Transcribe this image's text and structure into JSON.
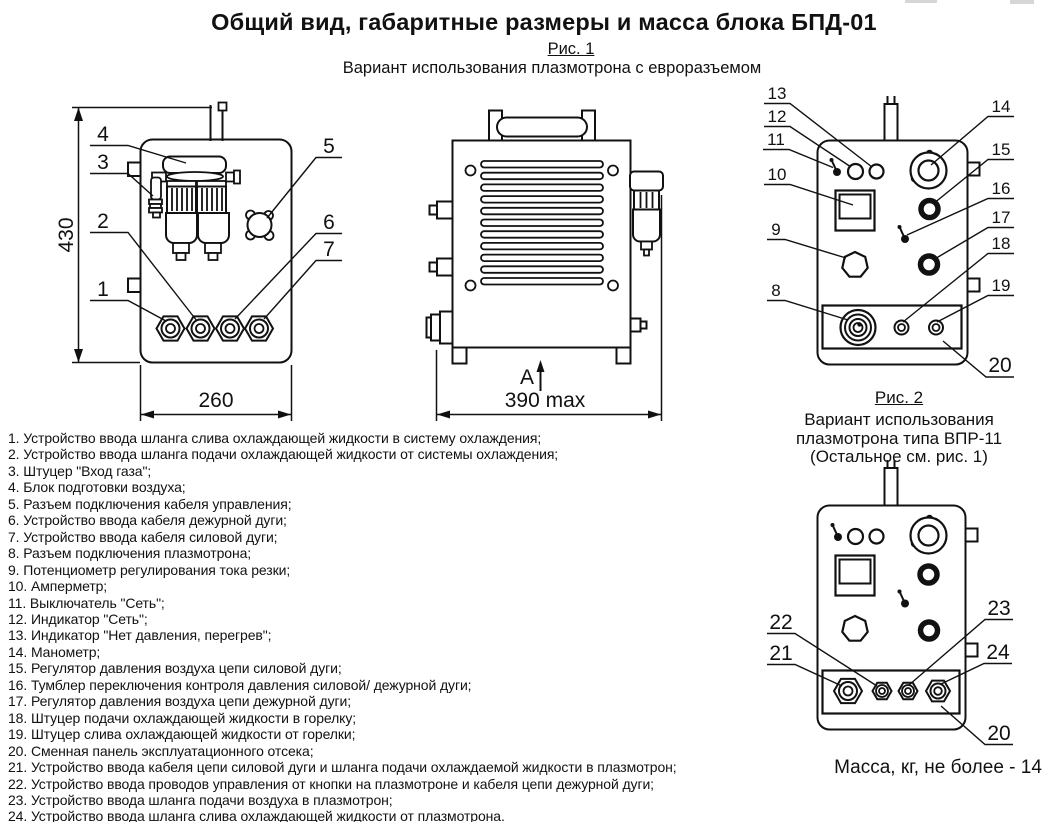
{
  "page": {
    "title": "Общий вид, габаритные размеры и масса блока БПД-01"
  },
  "fig1": {
    "caption": "Рис. 1",
    "subtitle": "Вариант использования плазмотрона с евроразъемом"
  },
  "fig2": {
    "caption": "Рис. 2",
    "line1": "Вариант использования",
    "line2": "плазмотрона типа ВПР-11",
    "line3": "(Остальное см. рис. 1)"
  },
  "mass_note": "Масса, кг, не более - 14",
  "dims": {
    "height": "430",
    "width": "260",
    "depth": "390 max",
    "view_label": "А"
  },
  "callouts": [
    "1",
    "2",
    "3",
    "4",
    "5",
    "6",
    "7",
    "8",
    "9",
    "10",
    "11",
    "12",
    "13",
    "14",
    "15",
    "16",
    "17",
    "18",
    "19",
    "20",
    "21",
    "22",
    "23",
    "24"
  ],
  "legend": [
    "1. Устройство ввода шланга слива охлаждающей жидкости в систему охлаждения;",
    "2. Устройство ввода шланга подачи охлаждающей жидкости от системы охлаждения;",
    "3. Штуцер \"Вход газа\";",
    "4. Блок подготовки воздуха;",
    "5. Разъем подключения кабеля управления;",
    "6. Устройство ввода кабеля дежурной дуги;",
    "7. Устройство ввода кабеля силовой дуги;",
    "8. Разъем подключения плазмотрона;",
    "9. Потенциометр регулирования тока резки;",
    "10. Амперметр;",
    "11. Выключатель \"Сеть\";",
    "12. Индикатор \"Сеть\";",
    "13. Индикатор \"Нет давления, перегрев\";",
    "14. Манометр;",
    "15. Регулятор давления воздуха цепи силовой дуги;",
    "16. Тумблер переключения контроля давления силовой/ дежурной дуги;",
    "17. Регулятор давления воздуха цепи дежурной дуги;",
    "18. Штуцер подачи охлаждающей жидкости в горелку;",
    "19. Штуцер слива охлаждающей жидкости от горелки;",
    "20. Сменная панель эксплуатационного отсека;",
    "21. Устройство ввода кабеля цепи силовой дуги и шланга подачи охлаждаемой жидкости в плазмотрон;",
    "22. Устройство ввода проводов управления от кнопки на плазмотроне и кабеля цепи дежурной дуги;",
    "23. Устройство ввода шланга подачи воздуха в плазмотрон;",
    "24. Устройство ввода шланга слива охлаждающей жидкости от плазмотрона."
  ]
}
